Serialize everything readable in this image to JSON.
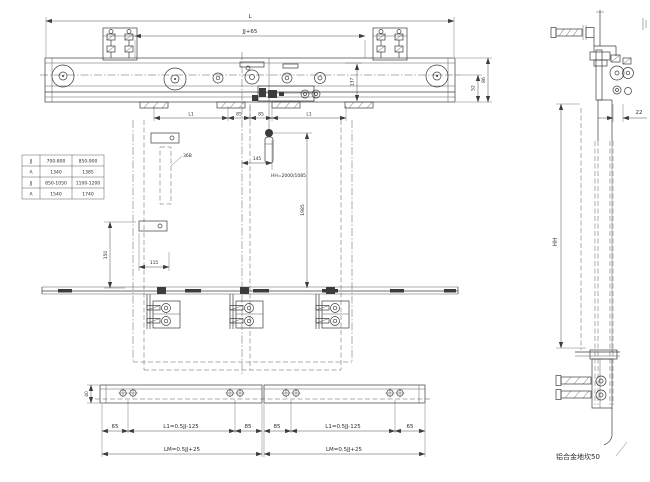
{
  "colors": {
    "line": "#3c3c3c",
    "background": "#ffffff"
  },
  "size_table": {
    "rows": [
      [
        "JJ",
        "700-800",
        "850-900"
      ],
      [
        "A",
        "1340",
        "1385"
      ],
      [
        "JJ",
        "850-1050",
        "1100-1200"
      ],
      [
        "A",
        "1540",
        "1740"
      ]
    ]
  },
  "front_view": {
    "dim_overall": "L",
    "dim_opening": "JJ+65",
    "dim_l1": "L1",
    "dim_85": "85",
    "dim_hanger_height": "137",
    "dim_beam_height": "86",
    "dim_rail": "52",
    "dim_cam_offset": "145",
    "dim_drop": "1985",
    "note_height": "HH=2000/1085",
    "part_label": "36B",
    "dim_bracket_drop": "150",
    "dim_bracket_inset": "115"
  },
  "bottom_view": {
    "dim_depth": "40",
    "dim_65": "65",
    "dim_85": "85",
    "dim_l1_formula": "L1=0.5JJ-125",
    "dim_lm_formula": "LM=0.5JJ+25"
  },
  "side_view": {
    "dim_gap": "22",
    "dim_height": "HH",
    "sill_note": "铝合金地坎50"
  }
}
